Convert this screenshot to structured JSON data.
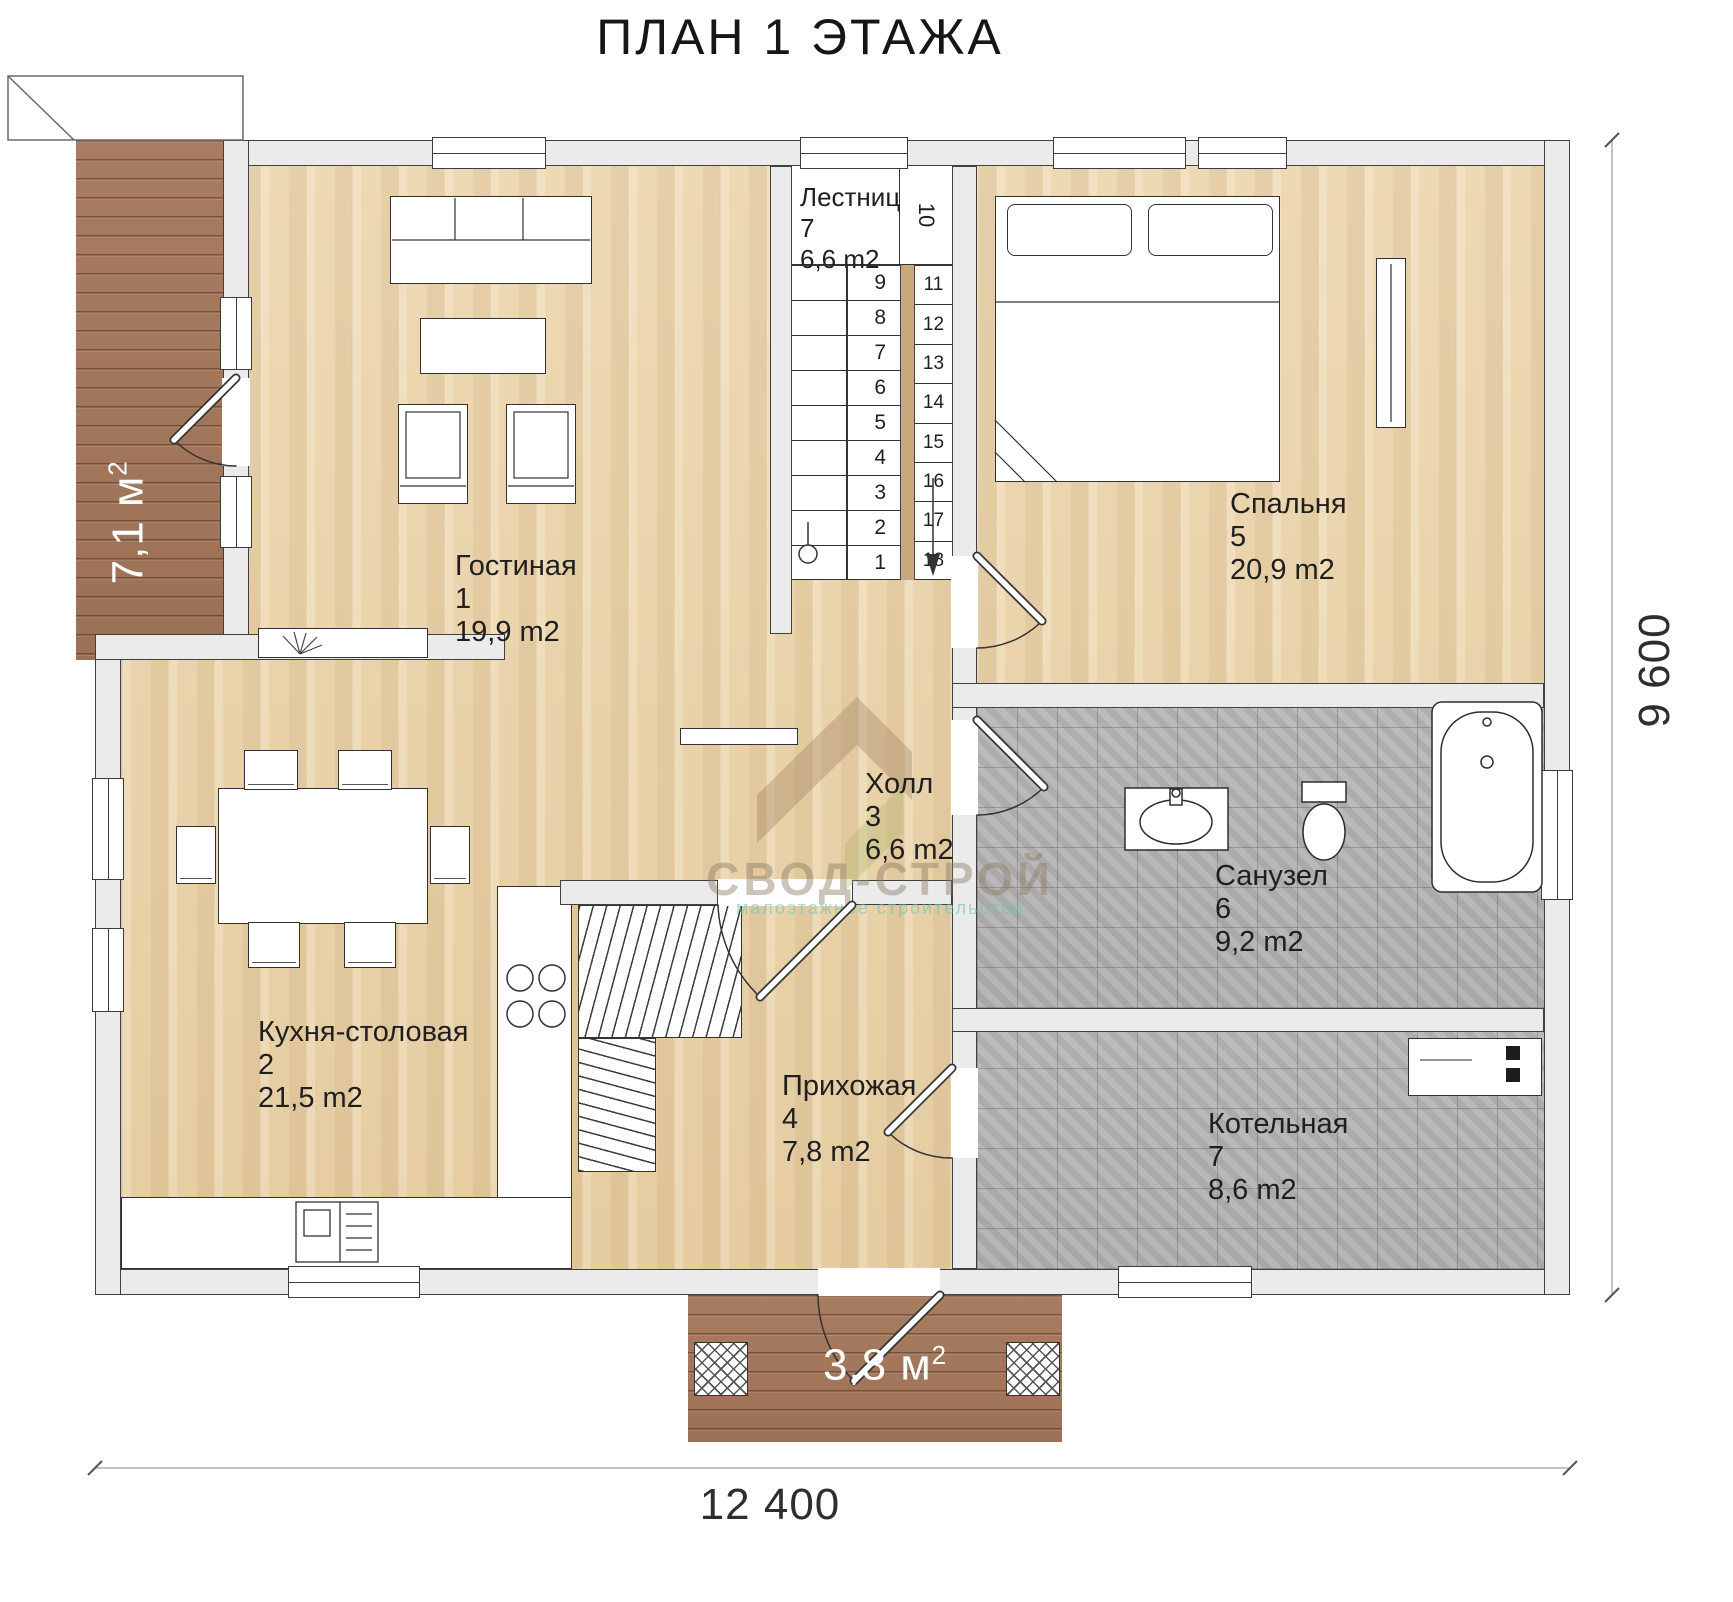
{
  "title": "ПЛАН 1 ЭТАЖА",
  "watermark": {
    "brand": "СВОД-СТРОЙ",
    "subtitle": "малоэтажное строительство"
  },
  "dimensions": {
    "width": "12 400",
    "height": "9 600"
  },
  "outdoor": {
    "terrace": {
      "area_value": "7,1 м",
      "area_sup": "2"
    },
    "porch": {
      "area_value": "3,8 м",
      "area_sup": "2"
    }
  },
  "rooms": {
    "living": {
      "name": "Гостиная",
      "number": "1",
      "area": "19,9 m2"
    },
    "kitchen": {
      "name": "Кухня-столовая",
      "number": "2",
      "area": "21,5 m2"
    },
    "hall": {
      "name": "Холл",
      "number": "3",
      "area": "6,6 m2"
    },
    "entry": {
      "name": "Прихожая",
      "number": "4",
      "area": "7,8 m2"
    },
    "bedroom": {
      "name": "Спальня",
      "number": "5",
      "area": "20,9 m2"
    },
    "bathroom": {
      "name": "Санузел",
      "number": "6",
      "area": "9,2 m2"
    },
    "boiler": {
      "name": "Котельная",
      "number": "7",
      "area": "8,6 m2"
    }
  },
  "stairs": {
    "name": "Лестница",
    "number": "7",
    "area": "6,6 m2",
    "left_steps": [
      "9",
      "8",
      "7",
      "6",
      "5",
      "4",
      "3",
      "2",
      "1"
    ],
    "turn_step": "10",
    "right_steps": [
      "11",
      "12",
      "13",
      "14",
      "15",
      "16",
      "17",
      "18"
    ]
  },
  "colors": {
    "wood": "#edd9b4",
    "tile": "#b7b7b7",
    "deck": "#a87c60",
    "wall": "#ebebeb"
  }
}
